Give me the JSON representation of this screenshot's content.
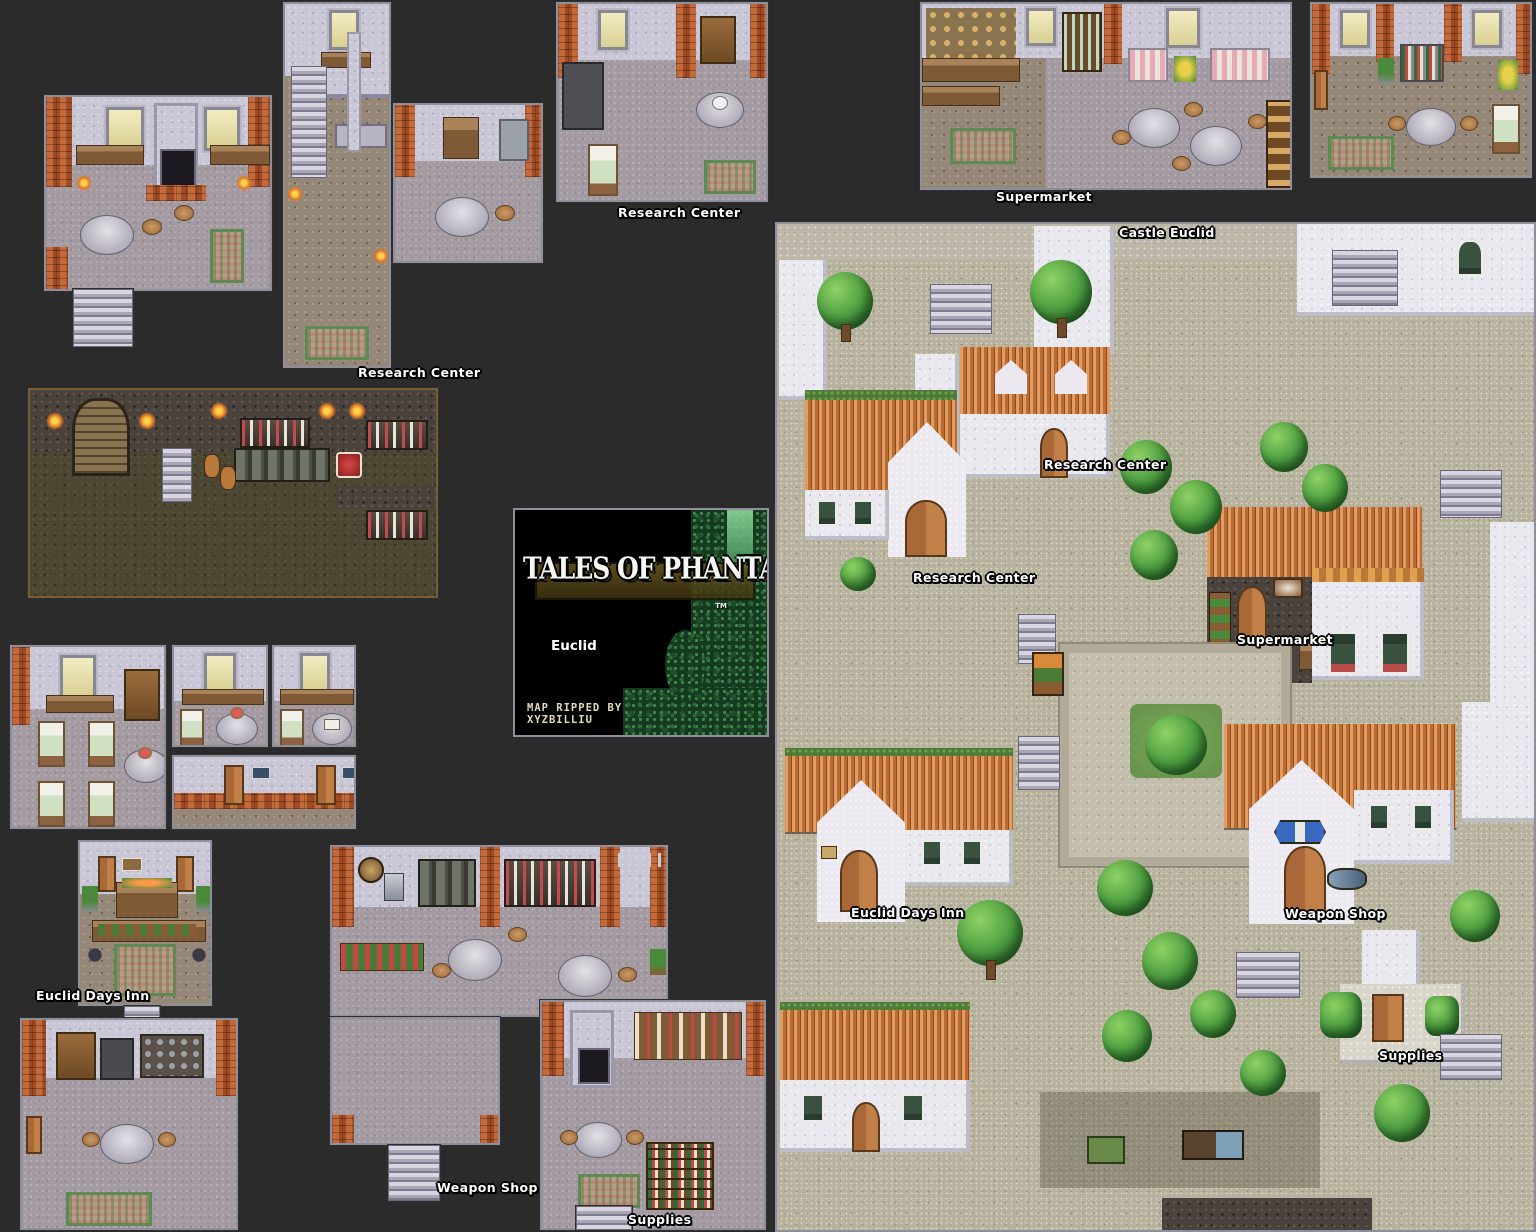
{
  "title_card": {
    "title": "TALES OF PHANTASIA",
    "trademark": "TM",
    "location": "Euclid",
    "credit_line_1": "MAP RIPPED BY",
    "credit_line_2": "XYZBILLIU"
  },
  "labels": {
    "research_center_small": "Research Center",
    "research_center_large": "Research Center",
    "supermarket_interior": "Supermarket",
    "castle_euclid": "Castle Euclid",
    "town_research_center_upper": "Research Center",
    "town_research_center_lower": "Research Center",
    "town_supermarket": "Supermarket",
    "town_euclid_days_inn": "Euclid Days Inn",
    "town_weapon_shop": "Weapon Shop",
    "town_supplies": "Supplies",
    "inn_lobby": "Euclid Days Inn",
    "weapon_shop_interior": "Weapon Shop",
    "supplies_interior": "Supplies"
  },
  "palette": {
    "background": "#2b2b2b",
    "label_text": "#ffffff",
    "label_outline": "#000000",
    "brick": "#b0562c",
    "roof_tile": "#cf8146",
    "white_wall": "#e9e8ee",
    "interior_floor": "#a49aa1",
    "street": "#b6b19e",
    "dark_floor": "#4c4733",
    "tree_green": "#4c9c40",
    "carpet_green": "#5d8a52",
    "title_background": "#000000",
    "foliage_green": "#2d6a3a"
  }
}
